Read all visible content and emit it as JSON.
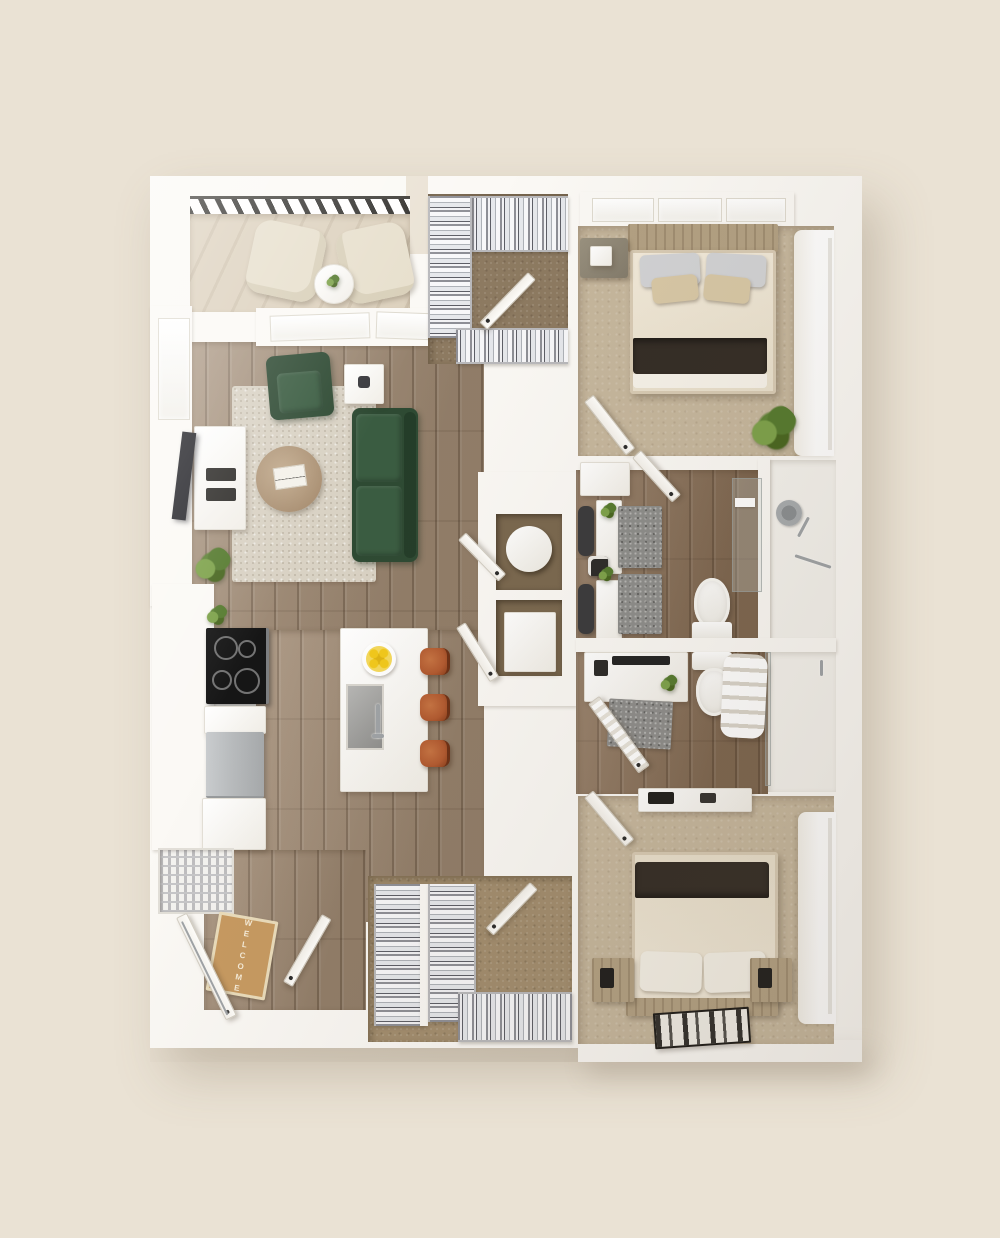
{
  "scene": {
    "type": "3d-top-down-apartment-floor-plan-render",
    "description": "Two bedroom, two bath apartment with open living/kitchen, two walk-in closets and a balcony"
  },
  "labels": {
    "welcome_mat": "WELCOME"
  },
  "rooms": [
    {
      "name": "balcony",
      "furniture": [
        "lounge-chair",
        "lounge-chair",
        "round-side-table",
        "railing"
      ]
    },
    {
      "name": "living-room",
      "furniture": [
        "green-sofa",
        "green-armchair",
        "area-rug",
        "round-coffee-table",
        "side-table",
        "tv",
        "media-console",
        "plant"
      ]
    },
    {
      "name": "kitchen",
      "furniture": [
        "cooktop",
        "refrigerator",
        "cabinets",
        "island-with-sink",
        "bar-stool",
        "bar-stool",
        "bar-stool",
        "lemon-bowl",
        "pantry-shelving"
      ]
    },
    {
      "name": "entry",
      "furniture": [
        "welcome-mat",
        "entry-door"
      ]
    },
    {
      "name": "walk-in-closet-top",
      "furniture": [
        "wire-shelving",
        "hanging-clothes"
      ]
    },
    {
      "name": "walk-in-closet-bottom",
      "furniture": [
        "wire-shelving",
        "hanging-clothes"
      ]
    },
    {
      "name": "bedroom-primary",
      "furniture": [
        "bed",
        "nightstand",
        "plant",
        "curtains",
        "windows"
      ]
    },
    {
      "name": "bedroom-secondary",
      "furniture": [
        "bed",
        "nightstand",
        "nightstand",
        "dresser",
        "patterned-rug",
        "curtains"
      ]
    },
    {
      "name": "dressing-hallway",
      "furniture": [
        "console",
        "console",
        "runner-rug",
        "runner-rug",
        "plant",
        "plant",
        "stool"
      ]
    },
    {
      "name": "bathroom-one",
      "furniture": [
        "toilet",
        "glass-shower",
        "shower-fixtures",
        "drain-mat"
      ]
    },
    {
      "name": "bathroom-two",
      "furniture": [
        "vanity",
        "toilet",
        "towel-ladder",
        "walk-in-shower",
        "bath-mat"
      ]
    }
  ],
  "palette": {
    "bg": "#EAE2D4",
    "plan-white": "#FBF9F5",
    "wood": "#A18B74",
    "wood-bath": "#8A7057",
    "wood-dark": "#7A684F",
    "carpet": "#C6B79D",
    "carpet-closet": "#8D7A61",
    "carpet-closet2": "#A28D6E",
    "balcony-floor": "#DCD0BC",
    "rug": "#D9D2C4",
    "gray-rug": "#8D8D8B",
    "sofa": "#2E4A33",
    "sofa-light": "#3A5C41",
    "stool": "#B25A30",
    "lemon": "#F2C91B",
    "blanket": "#332C25",
    "mat": "#C79A61",
    "mat-border": "#EADCBB",
    "tv": "#26262B",
    "fridge": "#B8BBBD",
    "cooktop": "#161616",
    "plant": "#5E8336",
    "wire": "#B9B9BC",
    "wood-furn": "#B3A183",
    "chrome": "#9FA3A6"
  }
}
